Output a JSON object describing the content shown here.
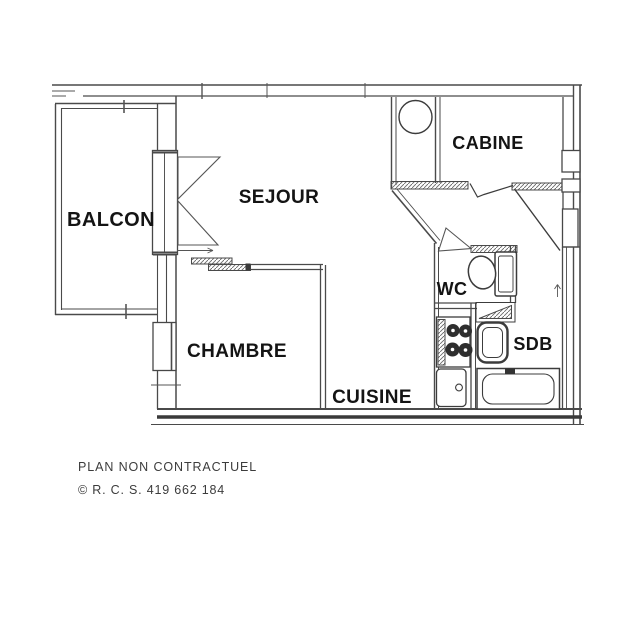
{
  "plan": {
    "rooms": [
      {
        "id": "balcon",
        "label": "BALCON"
      },
      {
        "id": "sejour",
        "label": "SEJOUR"
      },
      {
        "id": "cabine",
        "label": "CABINE"
      },
      {
        "id": "chambre",
        "label": "CHAMBRE"
      },
      {
        "id": "wc",
        "label": "WC"
      },
      {
        "id": "sdb",
        "label": "SDB"
      },
      {
        "id": "cuisine",
        "label": "CUISINE"
      }
    ],
    "fixtures": [
      "water-heater",
      "toilet",
      "washbasin",
      "bathtub",
      "cooktop",
      "kitchen-sink",
      "entrance-door-swing",
      "wc-door-swing",
      "balcony-french-door",
      "sliding-door"
    ],
    "footer": {
      "disclaimer": "PLAN NON CONTRACTUEL",
      "registration": "© R. C. S. 419 662 184"
    },
    "colors": {
      "line": "#4a4a4a",
      "label": "#141414",
      "background": "#ffffff"
    }
  }
}
